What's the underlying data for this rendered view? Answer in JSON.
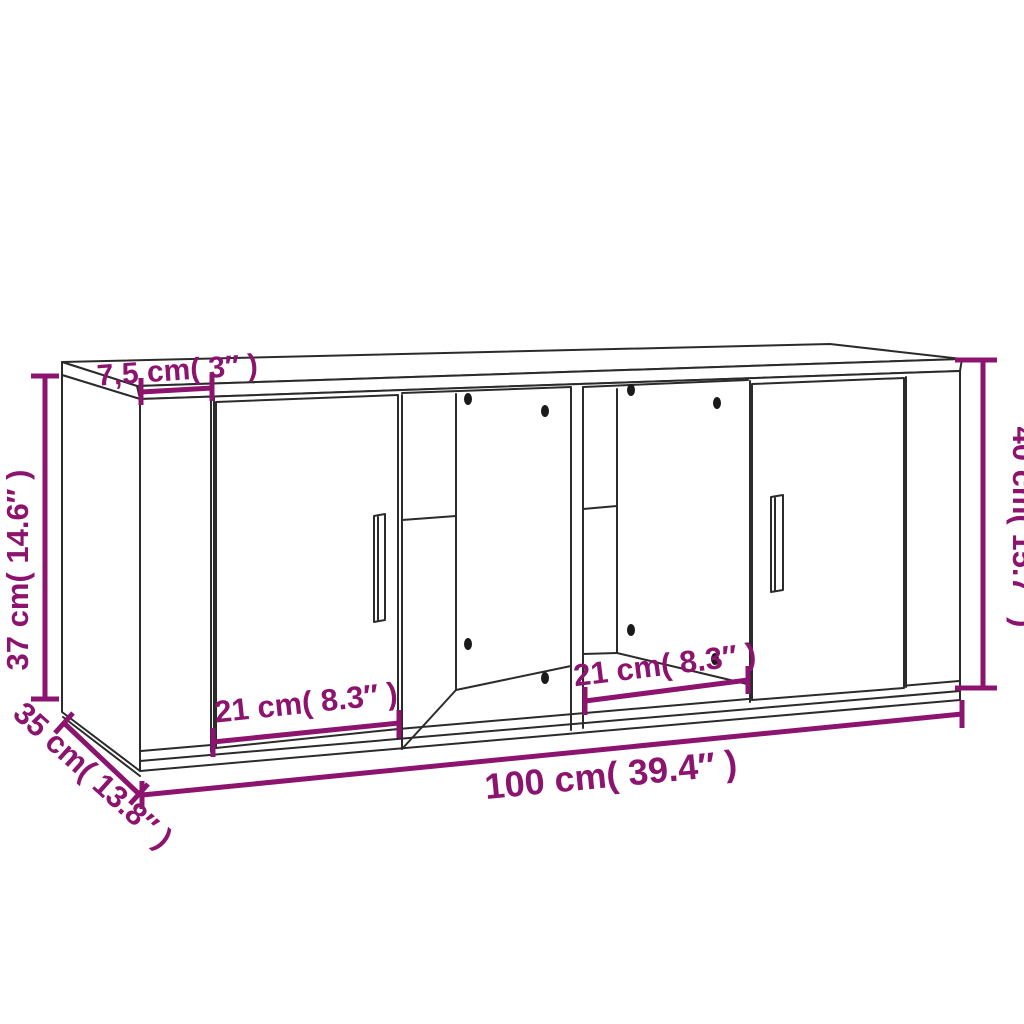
{
  "diagram": {
    "type": "furniture-dimension-diagram",
    "colors": {
      "dimension": "#8C146E",
      "outline": "#2B2B2B",
      "holes": "#1A1A1A",
      "background": "#FFFFFF"
    },
    "labels": {
      "top_front_edge_depth": "7,5 cm( 3″ )",
      "left_height": "37 cm( 14.6″ )",
      "right_height": "40 cm( 15.7″ )",
      "depth": "35 cm( 13.8″ )",
      "width": "100 cm( 39.4″ )",
      "left_door_width": "21 cm( 8.3″ )",
      "center_opening_width": "21 cm( 8.3″ )"
    }
  }
}
